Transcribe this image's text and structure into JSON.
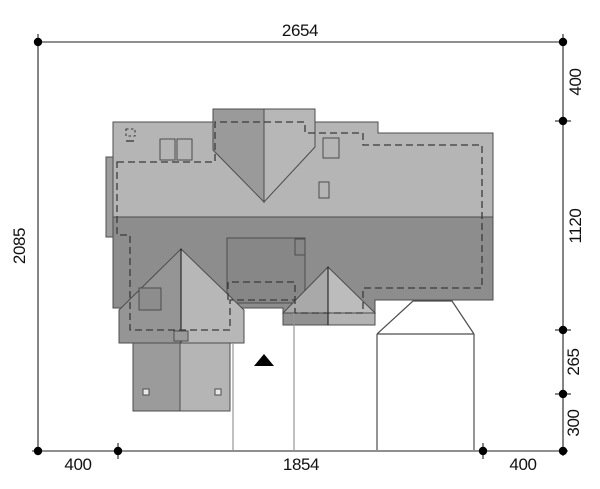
{
  "plan": {
    "kind": "house roof / site plan, top view",
    "north_arrow": "filled triangle pointing up"
  },
  "dimensions": {
    "top_total": "2654",
    "left_total": "2085",
    "right_segments": [
      "400",
      "1120",
      "265",
      "300"
    ],
    "bottom_segments": [
      "400",
      "1854",
      "400"
    ]
  },
  "colors": {
    "background": "#ffffff",
    "roof_light": "#b5b5b5",
    "roof_dark": "#8d8d8d",
    "face_west": "#9a9a9a",
    "face_west_dark": "#959595",
    "face_east": "#b7b7b7",
    "gable_left": "#a9a9a9",
    "gable_right": "#bcbcbc",
    "strip_left": "#919191",
    "strip_right": "#b3b3b3",
    "box_fill": "#878787",
    "side_strip": "#9d9d9d",
    "porch_left": "#9b9b9b",
    "porch_right": "#b5b5b5",
    "chimney_fill": "#8d8d8d",
    "post_fill": "#e8e8e8",
    "arrow": "#000000"
  }
}
